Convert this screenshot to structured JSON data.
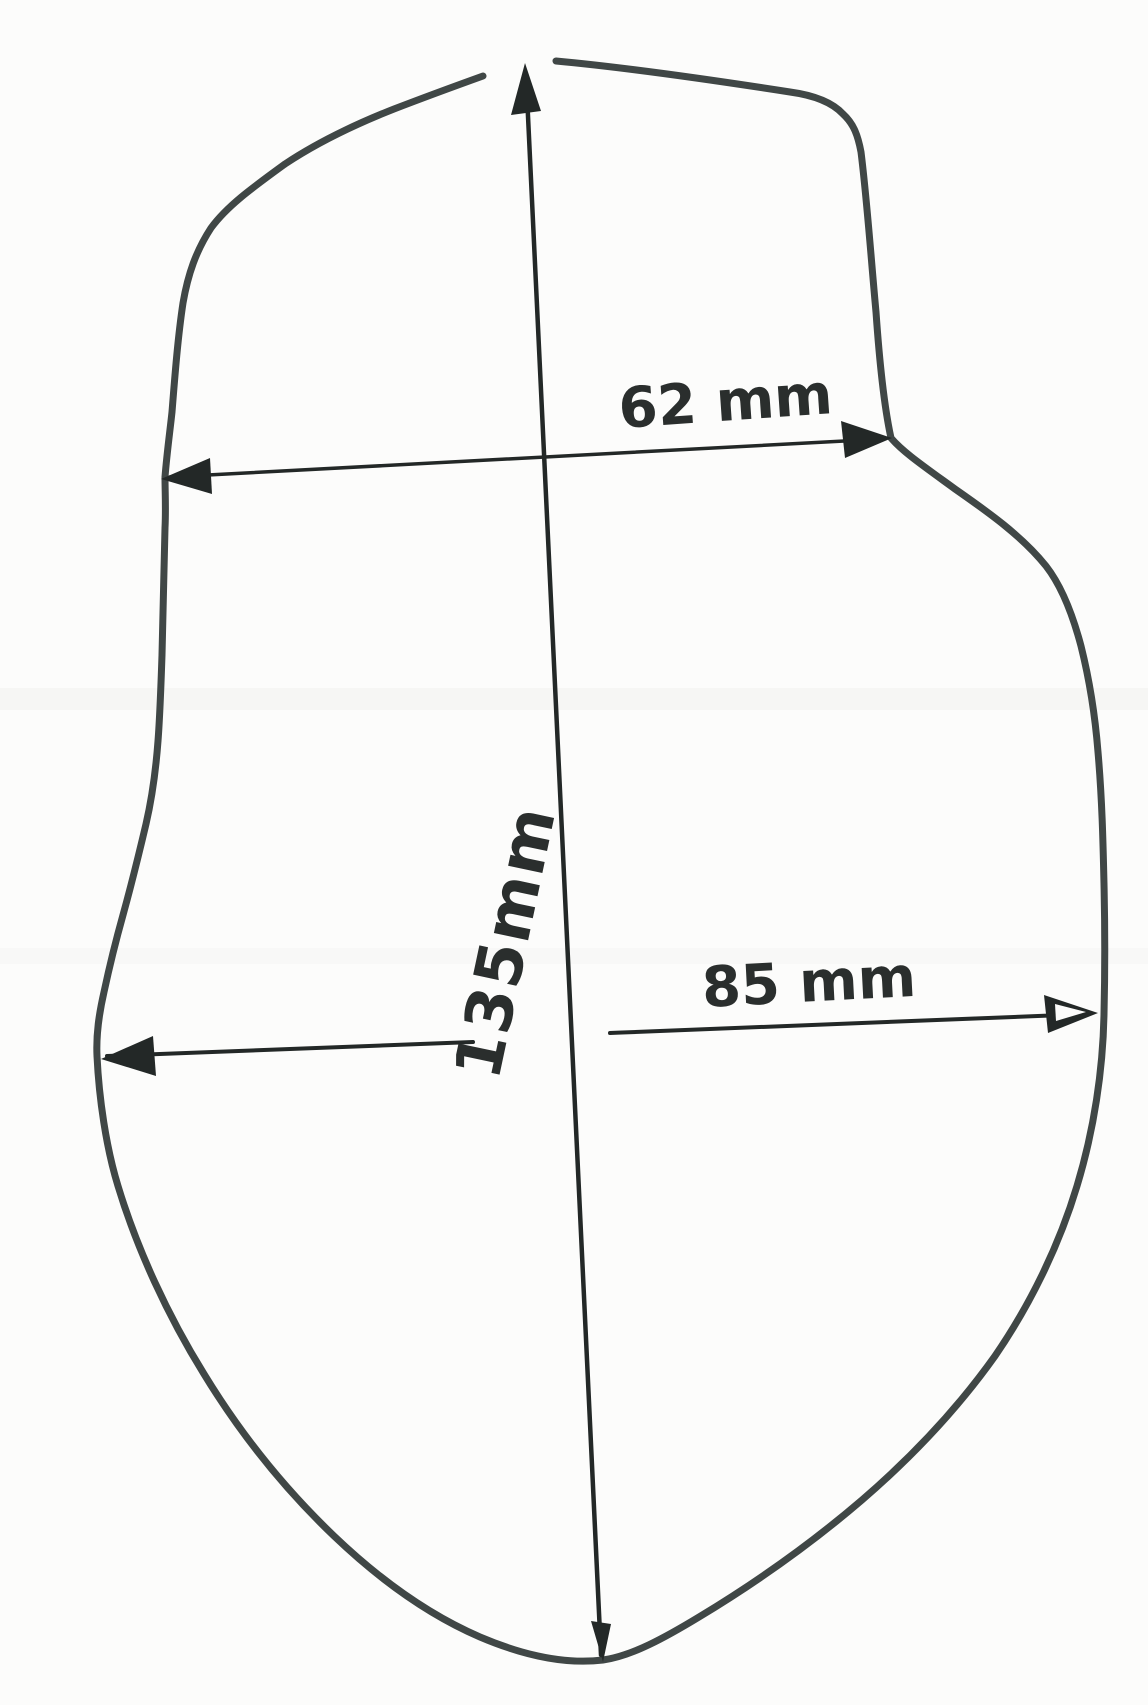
{
  "colors": {
    "paper": "#fcfcfb",
    "outline_ink": "#404746",
    "dimension_ink": "#232827",
    "text_ink": "#2a2e2d",
    "scan_artifact": "#d9d9d4"
  },
  "labels": {
    "width_top": "62 mm",
    "height": "135mm",
    "width_middle": "85 mm"
  },
  "values_mm": {
    "width_top": 62,
    "height": 135,
    "width_middle": 85
  }
}
